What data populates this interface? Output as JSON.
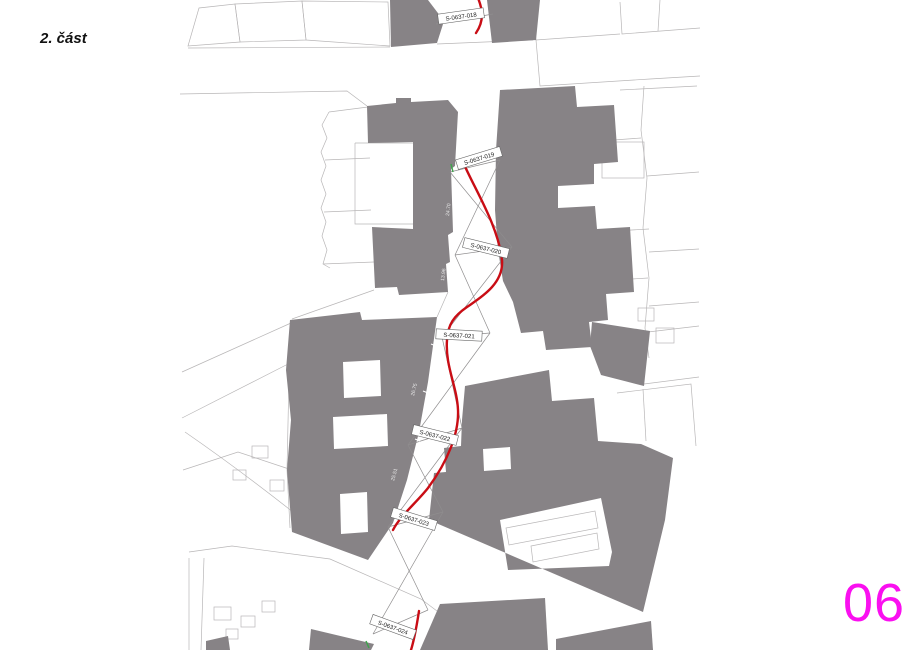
{
  "page": {
    "part_label": "2. část",
    "sheet_number": "06"
  },
  "colors": {
    "building_fill": "#878386",
    "route_red": "#c90d15",
    "sheet_number_magenta": "#fa0ff0",
    "parcel_line_gray": "#b8b6b7",
    "sight_line_gray": "#8f8d8e",
    "marker_green": "#3fa34d",
    "label_text": "#1a1a1a"
  },
  "map": {
    "type": "cadastral-survey-plan",
    "stations": [
      {
        "label": "S-0637-018"
      },
      {
        "label": "S-0637-019"
      },
      {
        "label": "S-0637-020"
      },
      {
        "label": "S-0637-021"
      },
      {
        "label": "S-0637-022"
      },
      {
        "label": "S-0637-023"
      },
      {
        "label": "S-0637-024"
      }
    ],
    "dimensions": [
      {
        "value": "24.70"
      },
      {
        "value": "13.96"
      },
      {
        "value": "26.75"
      },
      {
        "value": "25.51"
      }
    ]
  }
}
